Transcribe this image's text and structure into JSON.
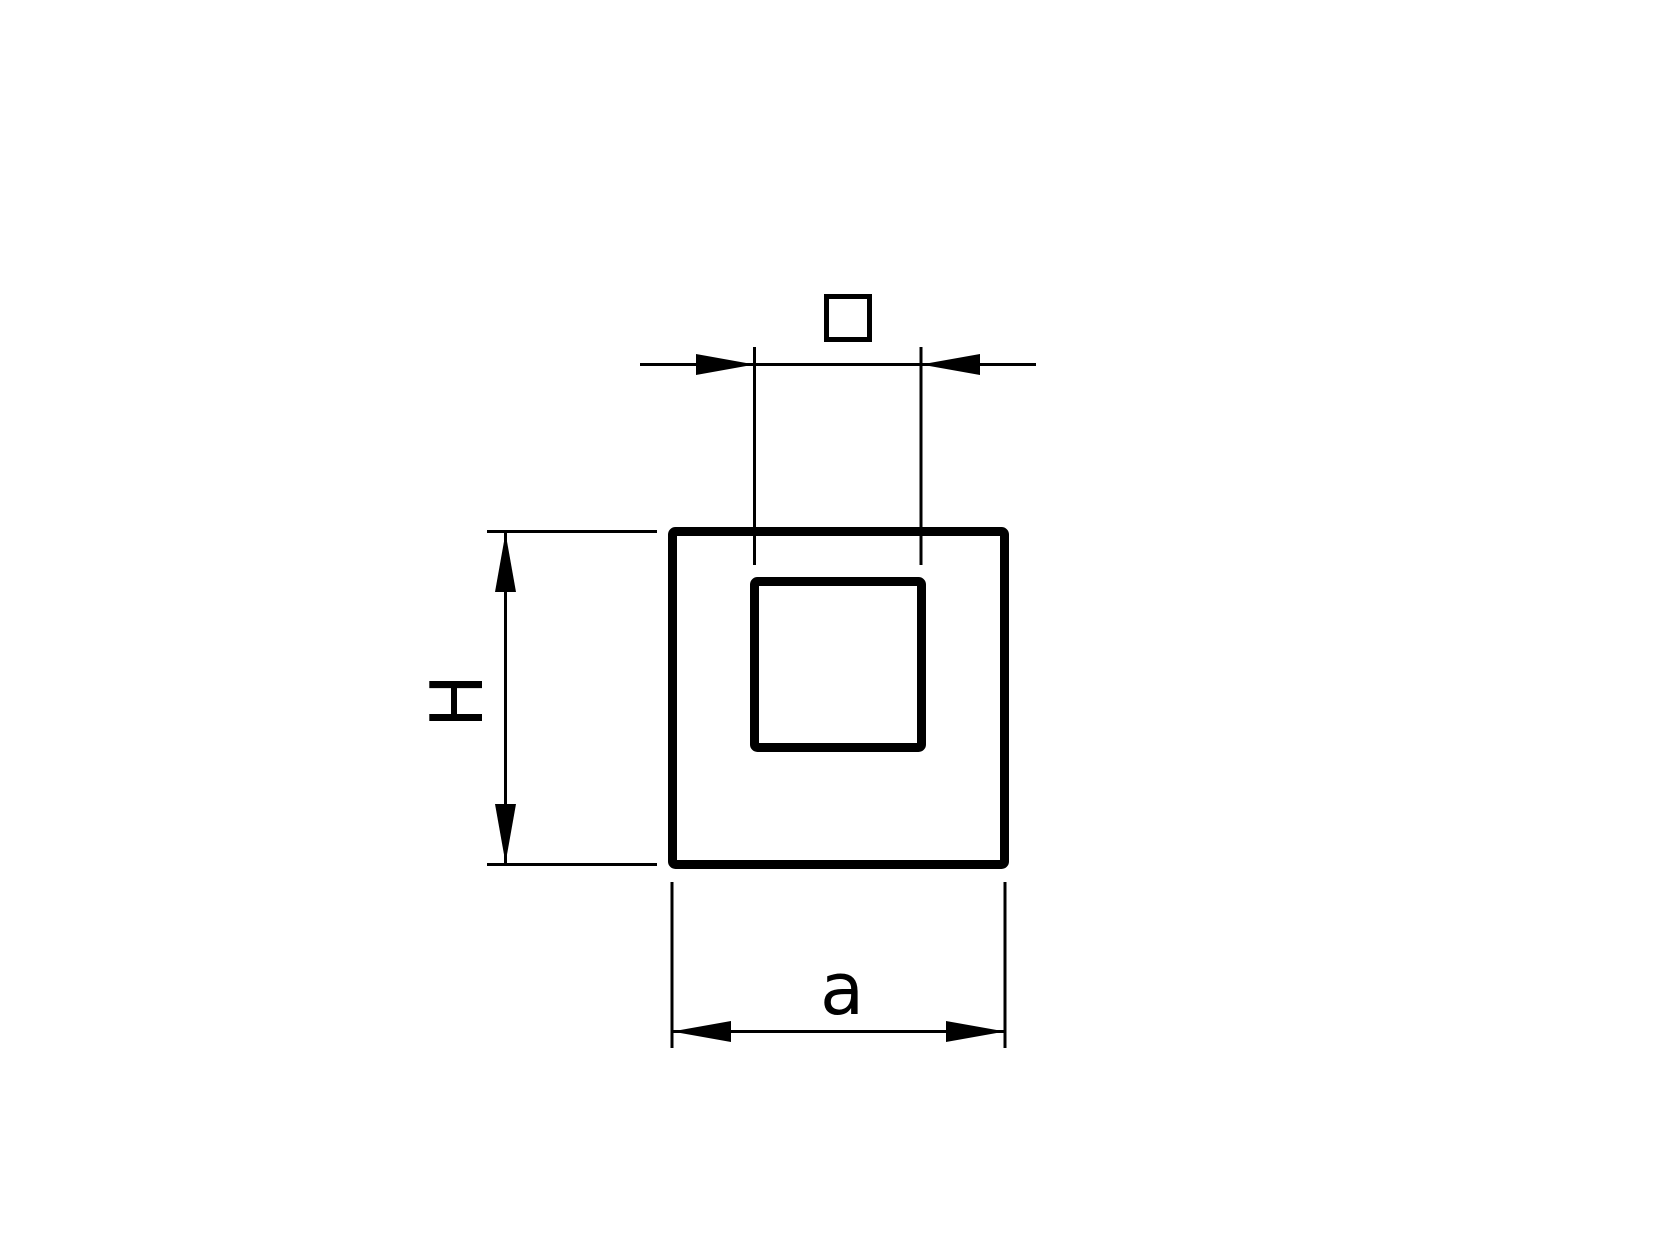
{
  "canvas": {
    "background_color": "#ffffff",
    "line_color": "#000000"
  },
  "drawing": {
    "labels": {
      "height_dimension": "H",
      "width_dimension": "a"
    },
    "icons": {
      "inner_width_symbol": "square-outline-icon"
    }
  }
}
